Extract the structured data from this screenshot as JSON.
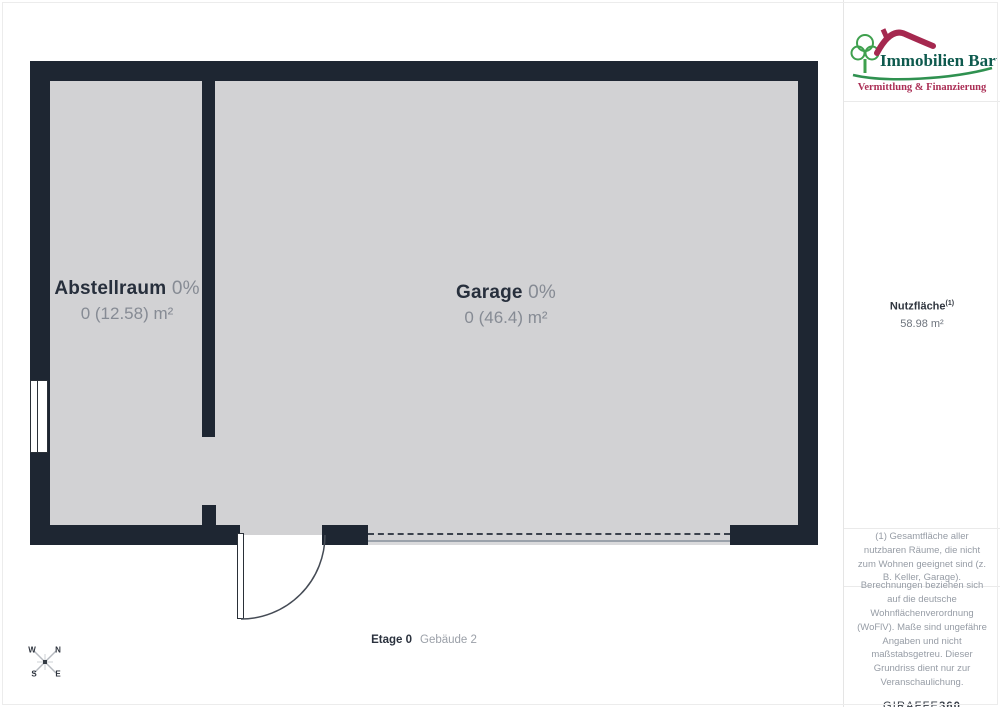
{
  "floorplan": {
    "rooms": [
      {
        "name": "Abstellraum",
        "percent": "0%",
        "area": "0 (12.58) m²"
      },
      {
        "name": "Garage",
        "percent": "0%",
        "area": "0 (46.4) m²"
      }
    ],
    "floor_label": {
      "name": "Etage 0",
      "building": "Gebäude 2"
    },
    "compass": {
      "top_left": "W",
      "top_right": "N",
      "bottom_left": "S",
      "bottom_right": "E"
    }
  },
  "sidebar": {
    "logo": {
      "company": "Immobilien Bart",
      "tagline": "Vermittlung & Finanzierung"
    },
    "metric": {
      "label": "Nutzfläche",
      "sup": "(1)",
      "value": "58.98 m²"
    },
    "footnote": "(1) Gesamtfläche aller nutzbaren Räume, die nicht zum Wohnen geeignet sind (z. B. Keller, Garage).",
    "disclaimer": "Berechnungen beziehen sich auf die deutsche Wohnflächenverordnung (WoFlV). Maße sind ungefähre Angaben und nicht maßstabsgetreu. Dieser Grundriss dient nur zur Veranschaulichung.",
    "brand": {
      "giraffe": "GIRAFFE",
      "n360": "360"
    }
  },
  "colors": {
    "wall": "#1e2632",
    "floor": "#d2d2d4",
    "text_dark": "#272f3c",
    "text_gray": "#868b94",
    "logo_green_text": "#0e5a4e",
    "logo_green_tree": "#3fa04e",
    "logo_red": "#a5284f"
  }
}
